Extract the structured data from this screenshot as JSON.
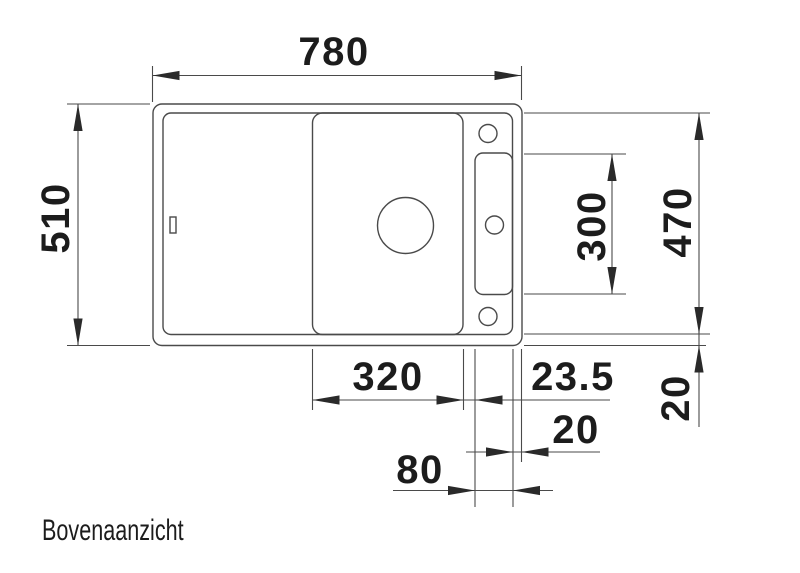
{
  "drawing": {
    "caption": "Bovenaanzicht",
    "dims": {
      "total_width": "780",
      "total_depth": "510",
      "ledge_length": "300",
      "inner_depth": "470",
      "rim_right_depth": "20",
      "bowl_width": "320",
      "bowl_ledge_gap": "23.5",
      "rim_bottom_width": "20",
      "ledge_width": "80"
    }
  }
}
